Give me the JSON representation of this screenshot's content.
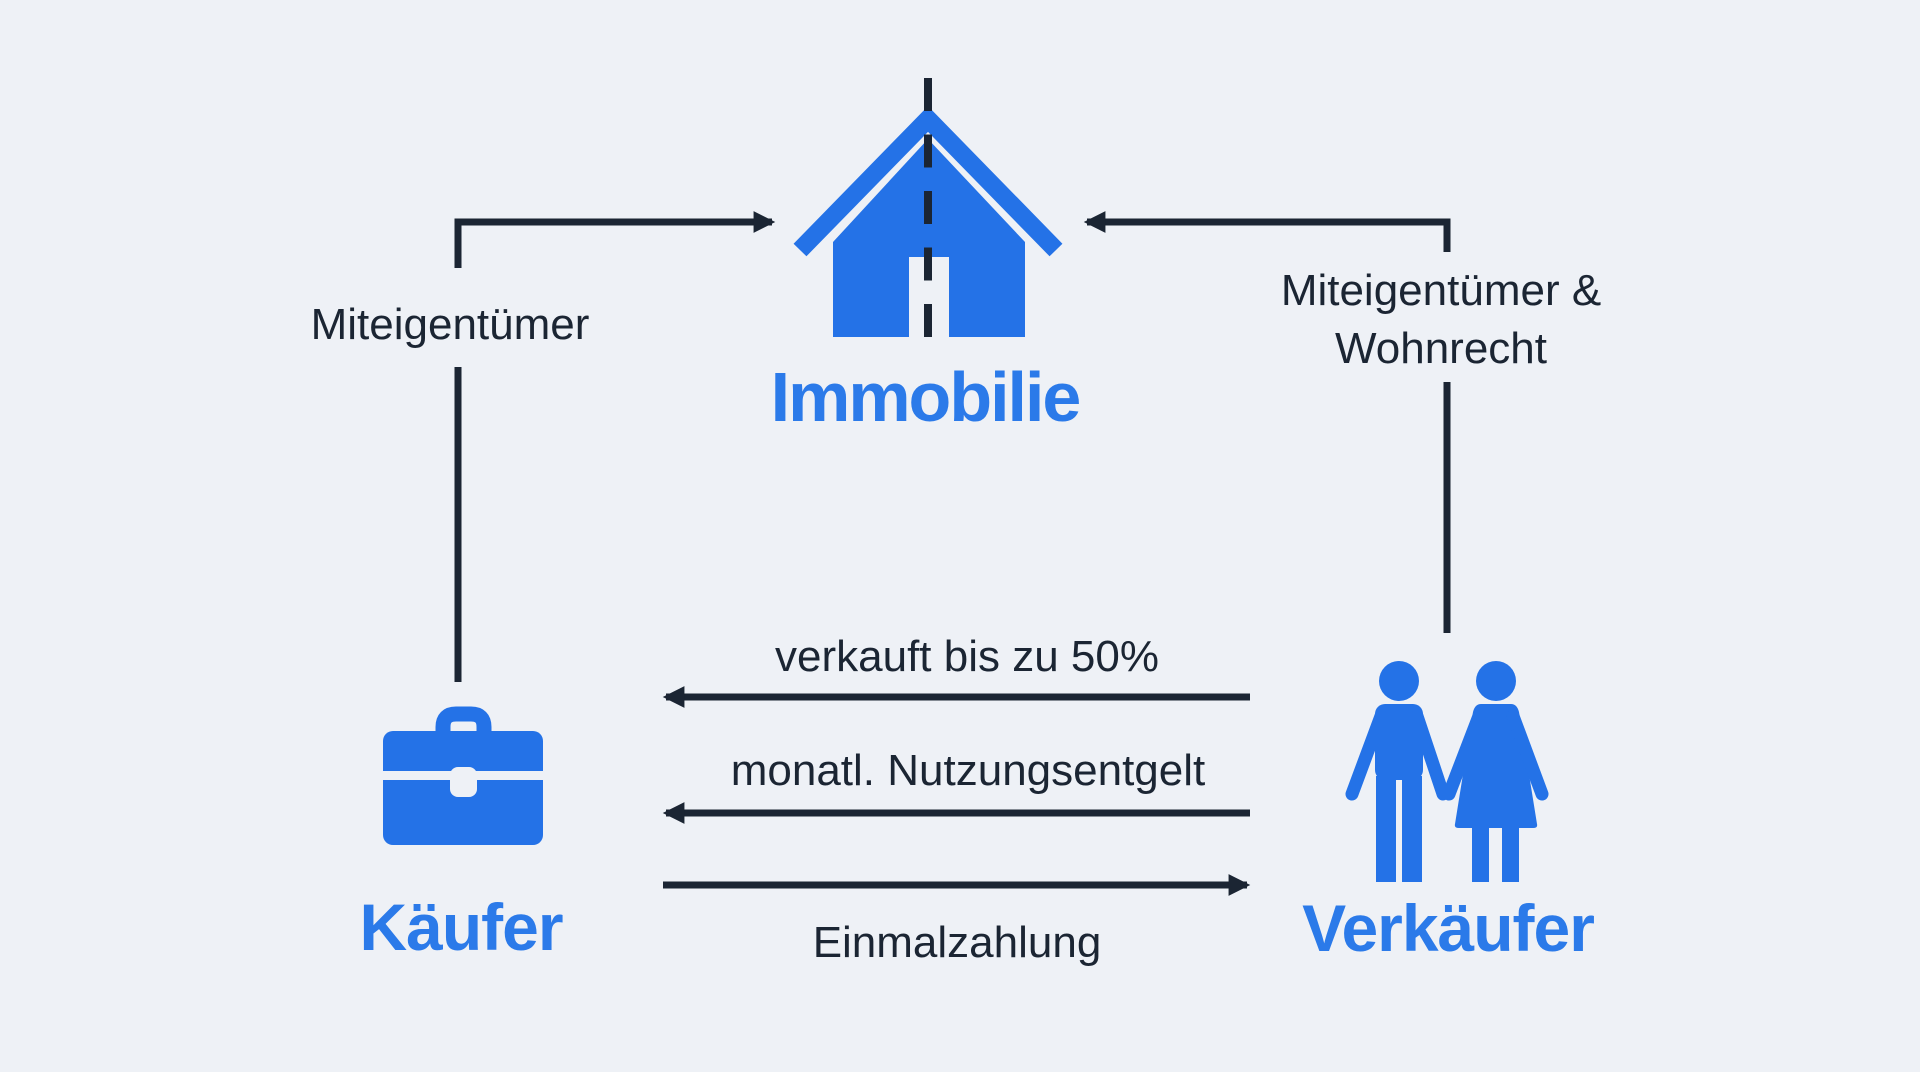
{
  "colors": {
    "bg": "#eef1f6",
    "dark": "#1b2533",
    "iconBlue": "#2472e7",
    "labelBlue": "#2b7ae9"
  },
  "nodes": {
    "property": {
      "label": "Immobilie",
      "icon": "house-icon"
    },
    "buyer": {
      "label": "Käufer",
      "icon": "briefcase-icon"
    },
    "seller": {
      "label": "Verkäufer",
      "icon": "couple-icon"
    }
  },
  "edges": {
    "buyer_property": {
      "label": "Miteigentümer"
    },
    "seller_property": {
      "line1": "Miteigentümer &",
      "line2": "Wohnrecht"
    },
    "seller_buyer_sale": {
      "label": "verkauft bis zu 50%"
    },
    "seller_buyer_fee": {
      "label": "monatl. Nutzungsentgelt"
    },
    "buyer_seller_payment": {
      "label": "Einmalzahlung"
    }
  }
}
